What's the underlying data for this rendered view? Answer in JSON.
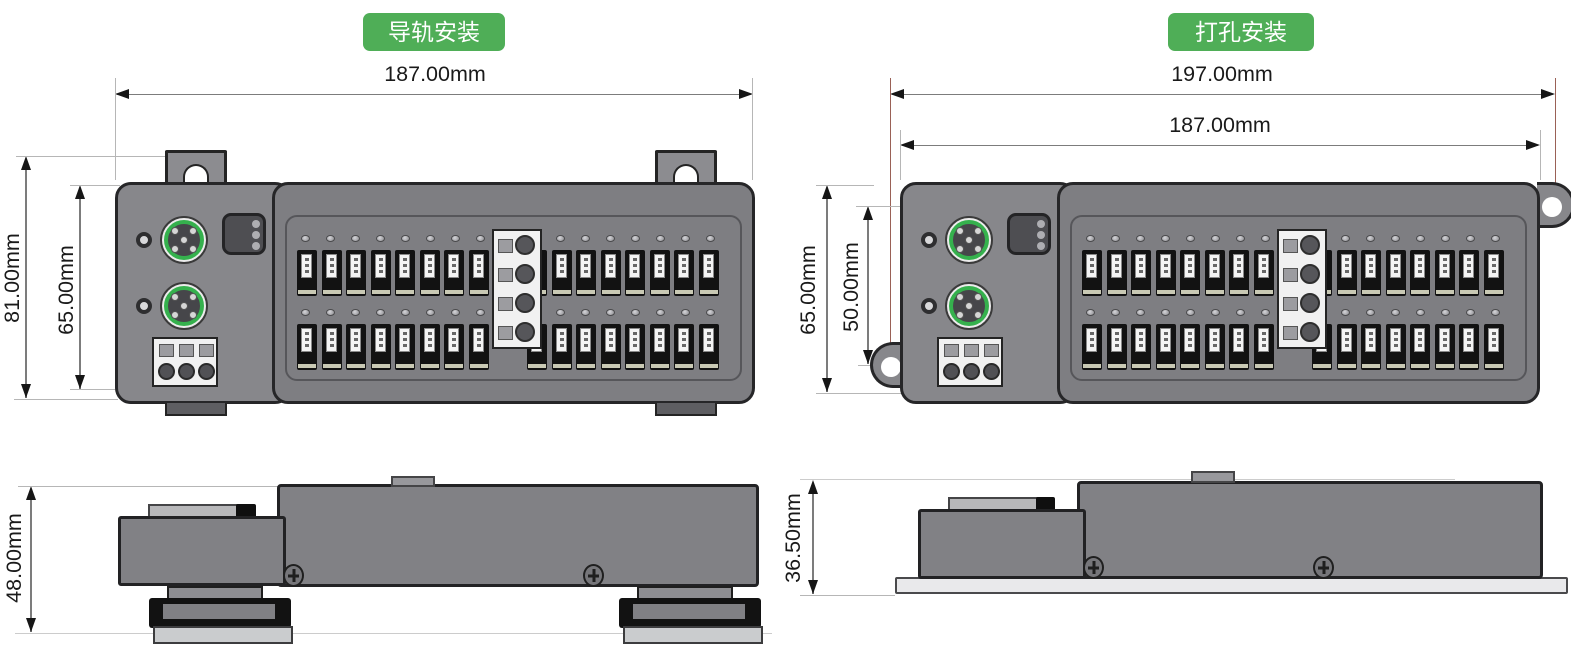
{
  "left_panel": {
    "badge": "导轨安装",
    "dims": {
      "width": "187.00mm",
      "height_outer": "81.00mm",
      "height_inner": "65.00mm",
      "side_height": "48.00mm"
    }
  },
  "right_panel": {
    "badge": "打孔安装",
    "dims": {
      "width_outer": "197.00mm",
      "width_inner": "187.00mm",
      "height_outer": "65.00mm",
      "height_inner": "50.00mm",
      "side_height": "36.50mm"
    }
  },
  "device": {
    "m12_connectors": 2,
    "status_leds": 3,
    "power_pins": 3,
    "terminal_groups": 2,
    "terminal_columns": 8,
    "terminal_rows": 2,
    "middle_pins": 4,
    "side_screws": 2,
    "rail_feet": 2
  },
  "colors": {
    "badge_green": "#4fae57",
    "connector_ring_green": "#35b14d",
    "body_gray": "#85858a",
    "panel_gray": "#7e7e82",
    "outline": "#262628",
    "dim_line": "#7c7c7c",
    "extension_line": "#b6b6b6",
    "hole_distance_line": "#9a6156",
    "terminal_black": "#121212",
    "background": "#ffffff"
  }
}
